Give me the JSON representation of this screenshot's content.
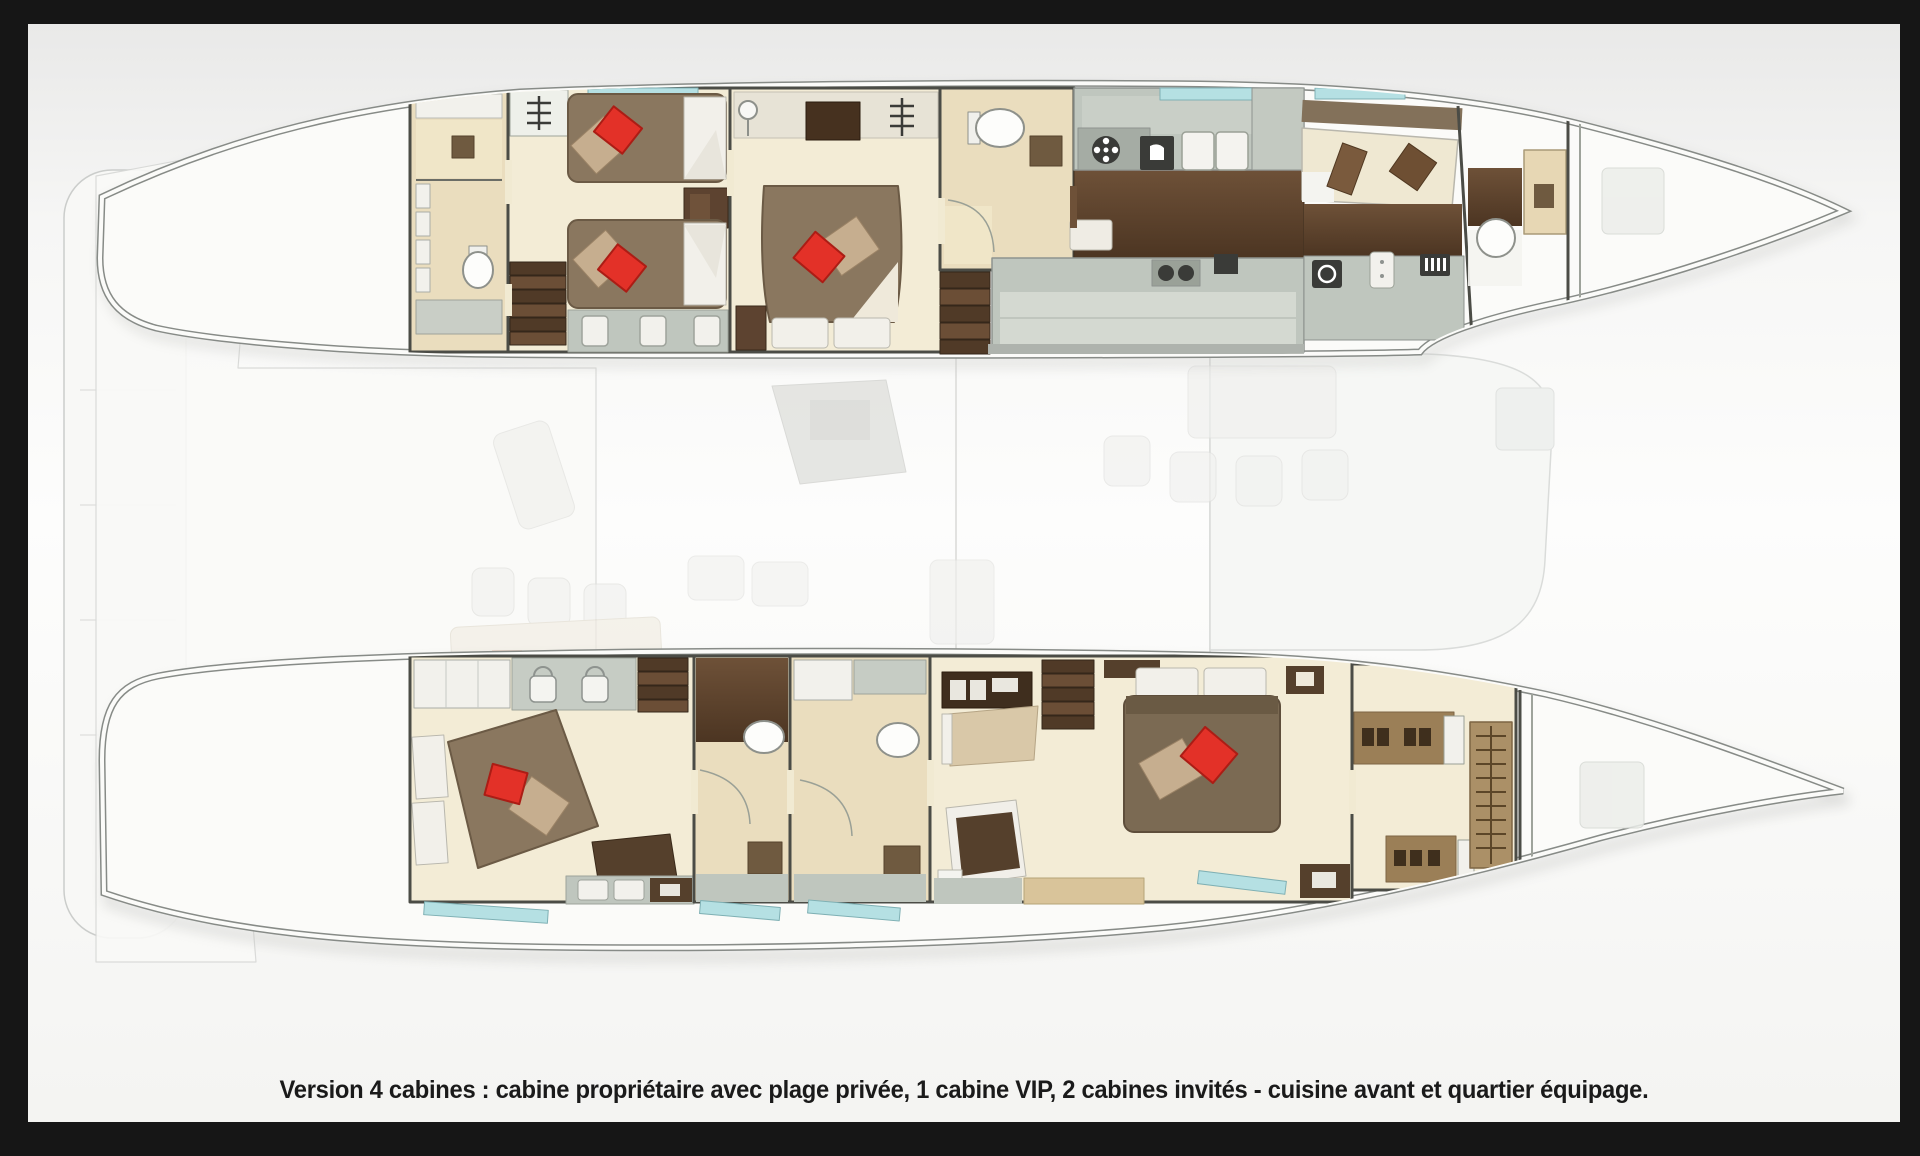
{
  "caption": {
    "text": "Version 4 cabines : cabine propriétaire avec plage privée, 1 cabine VIP, 2 cabines invités - cuisine avant et quartier équipage."
  },
  "palette": {
    "frame_black": "#161616",
    "canvas_white": "#fcfcfb",
    "hull_line": "#878b87",
    "floor_cream": "#f3ecd6",
    "floor_beige": "#eaddbe",
    "wood_dark": "#5a402b",
    "bed_taupe": "#8a775f",
    "bed_edge": "#6b5a45",
    "pillow_red": "#e33128",
    "pillow_red_dark": "#ab1d15",
    "pillow_beige": "#c6ae8f",
    "counter_gray": "#bfc6be",
    "counter_light": "#d4d9d1",
    "appliance_dark": "#3a3b38",
    "wall_dark": "#4b4c46",
    "window_teal": "#b5e0e3",
    "white_fixture": "#f2f1ec",
    "shelf_tan": "#9b7f57",
    "caption_color": "#1a1a1a"
  }
}
